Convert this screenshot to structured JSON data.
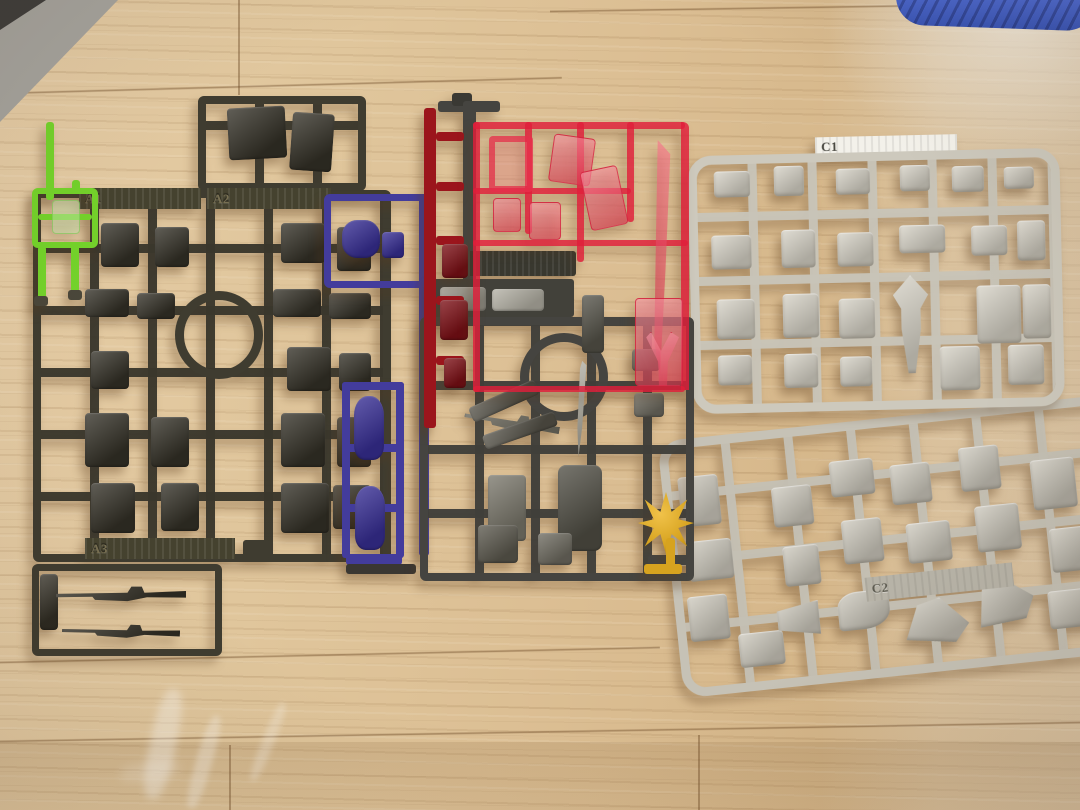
{
  "scene": {
    "description": "Photo of five plastic model-kit part runners (sprues) laid out on a light wooden floor",
    "surface": "light wood flooring with plank seams",
    "background_objects": [
      "grey mat corner top-left",
      "blue rolled object top-right",
      "plastic-bag glare bottom-left"
    ]
  },
  "colors": {
    "wood": "#dfc49c",
    "runner_dark_olive": "#3f3c30",
    "runner_green": "#74d32b",
    "runner_blue": "#433c9c",
    "runner_red_solid": "#9b151c",
    "runner_red_clear": "#e01e3a",
    "runner_grey_dark": "#454440",
    "runner_grey_light": "#cdc9bd",
    "runner_grey_light2": "#c6c2b6",
    "part_gold": "#d7a31f",
    "mat_grey": "#a6a49e",
    "mat_dark": "#3f3e3c",
    "blue_object": "#3f5cbe"
  },
  "runners": {
    "a1": {
      "label": "A1",
      "color_name": "dark olive grey"
    },
    "a2": {
      "label": "A2",
      "color_name": "dark olive grey"
    },
    "a3": {
      "label": "A3",
      "color_name": "dark olive grey"
    },
    "c1": {
      "label": "C1",
      "color_name": "light grey"
    },
    "c2": {
      "label": "C2",
      "color_name": "light grey"
    }
  }
}
